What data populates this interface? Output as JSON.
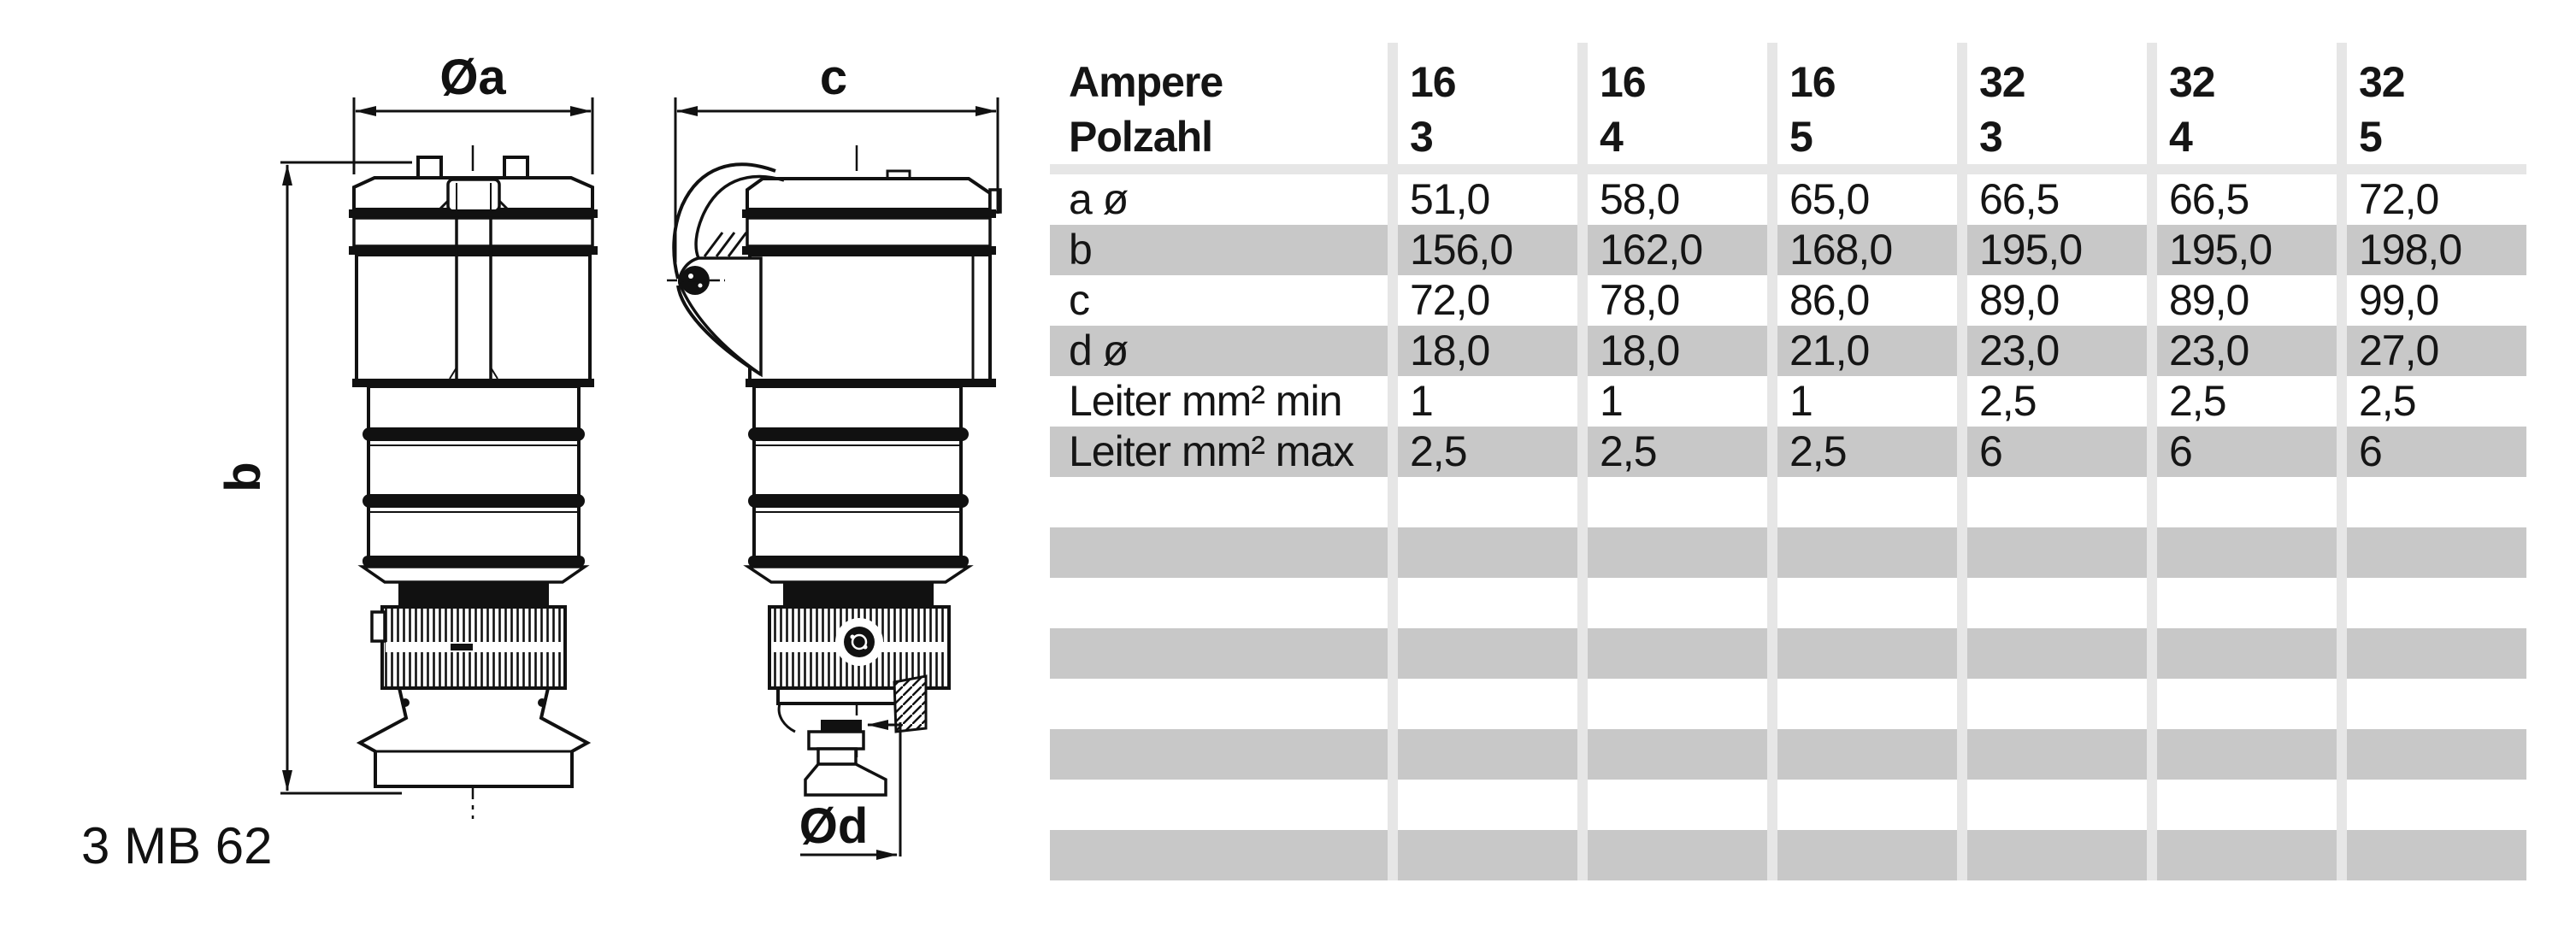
{
  "drawing": {
    "dim_a_label": "Øa",
    "dim_b_label": "b",
    "dim_c_label": "c",
    "dim_d_label": "Ød",
    "figure_code": "3 MB 62"
  },
  "table": {
    "header": {
      "col_label_line1": "Ampere",
      "col_label_line2": "Polzahl",
      "columns": [
        {
          "ampere": "16",
          "polzahl": "3"
        },
        {
          "ampere": "16",
          "polzahl": "4"
        },
        {
          "ampere": "16",
          "polzahl": "5"
        },
        {
          "ampere": "32",
          "polzahl": "3"
        },
        {
          "ampere": "32",
          "polzahl": "4"
        },
        {
          "ampere": "32",
          "polzahl": "5"
        }
      ]
    },
    "rows": [
      {
        "label": "a ø",
        "values": [
          "51,0",
          "58,0",
          "65,0",
          "66,5",
          "66,5",
          "72,0"
        ]
      },
      {
        "label": "b",
        "values": [
          "156,0",
          "162,0",
          "168,0",
          "195,0",
          "195,0",
          "198,0"
        ]
      },
      {
        "label": "c",
        "values": [
          "72,0",
          "78,0",
          "86,0",
          "89,0",
          "89,0",
          "99,0"
        ]
      },
      {
        "label": "d ø",
        "values": [
          "18,0",
          "18,0",
          "21,0",
          "23,0",
          "23,0",
          "27,0"
        ]
      },
      {
        "label": "Leiter mm² min",
        "values": [
          "1",
          "1",
          "1",
          "2,5",
          "2,5",
          "2,5"
        ]
      },
      {
        "label": "Leiter mm² max",
        "values": [
          "2,5",
          "2,5",
          "2,5",
          "6",
          "6",
          "6"
        ]
      }
    ],
    "empty_row_count": 8,
    "colors": {
      "row_stripe": "#c8c8c8",
      "grid_line": "#e6e6e6",
      "ink": "#151515"
    }
  }
}
